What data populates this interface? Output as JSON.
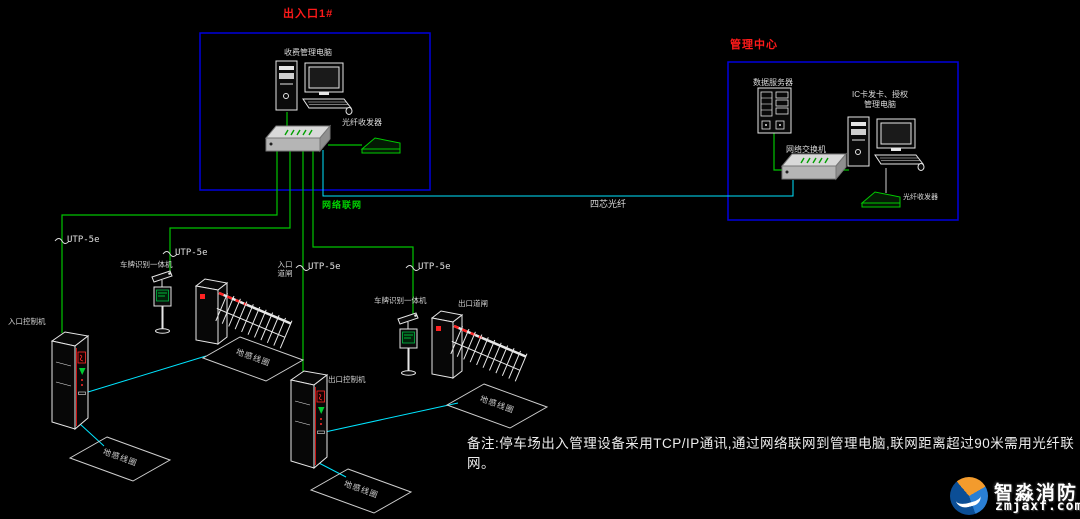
{
  "colors": {
    "background": "#000000",
    "line_green": "#00c400",
    "line_cyan": "#00e5ff",
    "zone_blue": "#0000dd",
    "label_red": "#ff1a1a",
    "label_white": "#dcdcdc"
  },
  "entrance_zone": {
    "title": "出入口1#",
    "pc_label": "收费管理电脑",
    "transceiver_label": "光纤收发器"
  },
  "management_zone": {
    "title": "管理中心",
    "server_label": "数据服务器",
    "ic_pc_label_line1": "IC卡发卡、授权",
    "ic_pc_label_line2": "管理电脑",
    "switch_label": "网络交换机",
    "transceiver_label": "光纤收发器"
  },
  "cables": {
    "network_label": "网络联网",
    "fiber_label": "四芯光纤",
    "utp_labels": [
      "UTP-5e",
      "UTP-5e",
      "UTP-5e",
      "UTP-5e"
    ]
  },
  "field_devices": {
    "camera1_label": "车牌识别一体机",
    "camera2_label": "车牌识别一体机",
    "entrance_barrier_label_line1": "入口",
    "entrance_barrier_label_line2": "道闸",
    "exit_barrier_label": "出口道闸",
    "entrance_kiosk_label": "入口控制机",
    "exit_kiosk_label": "出口控制机",
    "coil_labels": [
      "地感线圈",
      "地感线圈",
      "地感线圈",
      "地感线圈"
    ]
  },
  "note": "备注:停车场出入管理设备采用TCP/IP通讯,通过网络联网到管理电脑,联网距离超过90米需用光纤联网。",
  "logo": {
    "name": "智淼消防",
    "url": "zmjaxf.com"
  }
}
